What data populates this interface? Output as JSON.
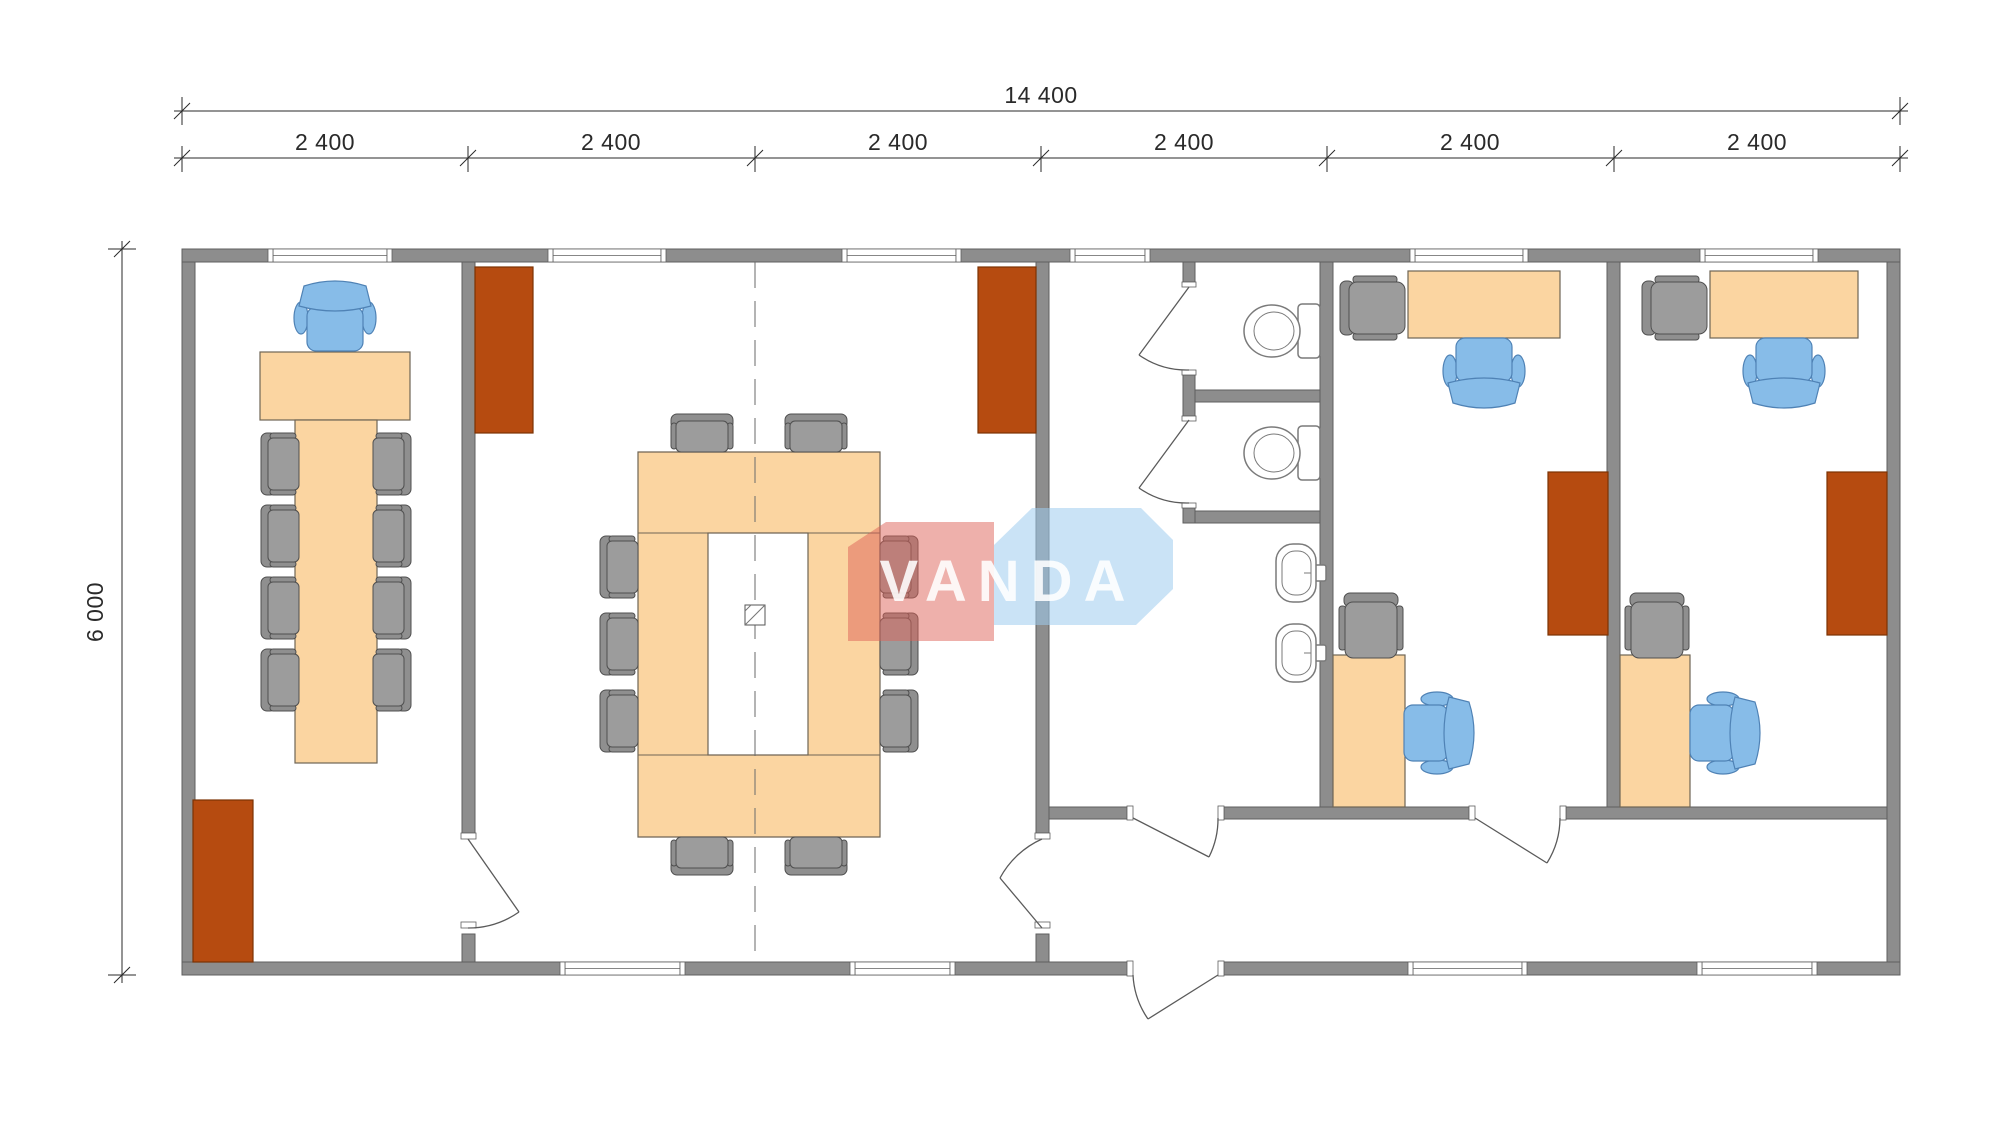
{
  "dimensions": {
    "total_width": "14 400",
    "total_depth": "6 000",
    "modules": [
      "2 400",
      "2 400",
      "2 400",
      "2 400",
      "2 400",
      "2 400"
    ]
  },
  "watermark": {
    "text": "VANDA"
  },
  "colors": {
    "bg": "#ffffff",
    "wall-fill": "#8d8d8d",
    "wall-stroke": "#5f5f5f",
    "wood-fill": "#fbd5a1",
    "wood-stroke": "#6f6555",
    "cabinet-fill": "#b64b10",
    "cabinet-stroke": "#7c3203",
    "chair-blue-fill": "#87bce8",
    "chair-blue-stroke": "#4f82b5",
    "chair-gray-fill": "#9c9c9c",
    "chair-gray-back": "#8f8f8f",
    "chair-gray-stroke": "#4f4f4f",
    "fixture-stroke": "#7a7a7a",
    "door-stroke": "#5a5a5a",
    "dim-color": "#2a2a2a",
    "centerline": "#6a6a6a",
    "wm-red": "rgba(222,98,88,0.50)",
    "wm-blue": "rgba(158,204,238,0.55)",
    "wm-text": "rgba(255,255,255,0.88)"
  }
}
